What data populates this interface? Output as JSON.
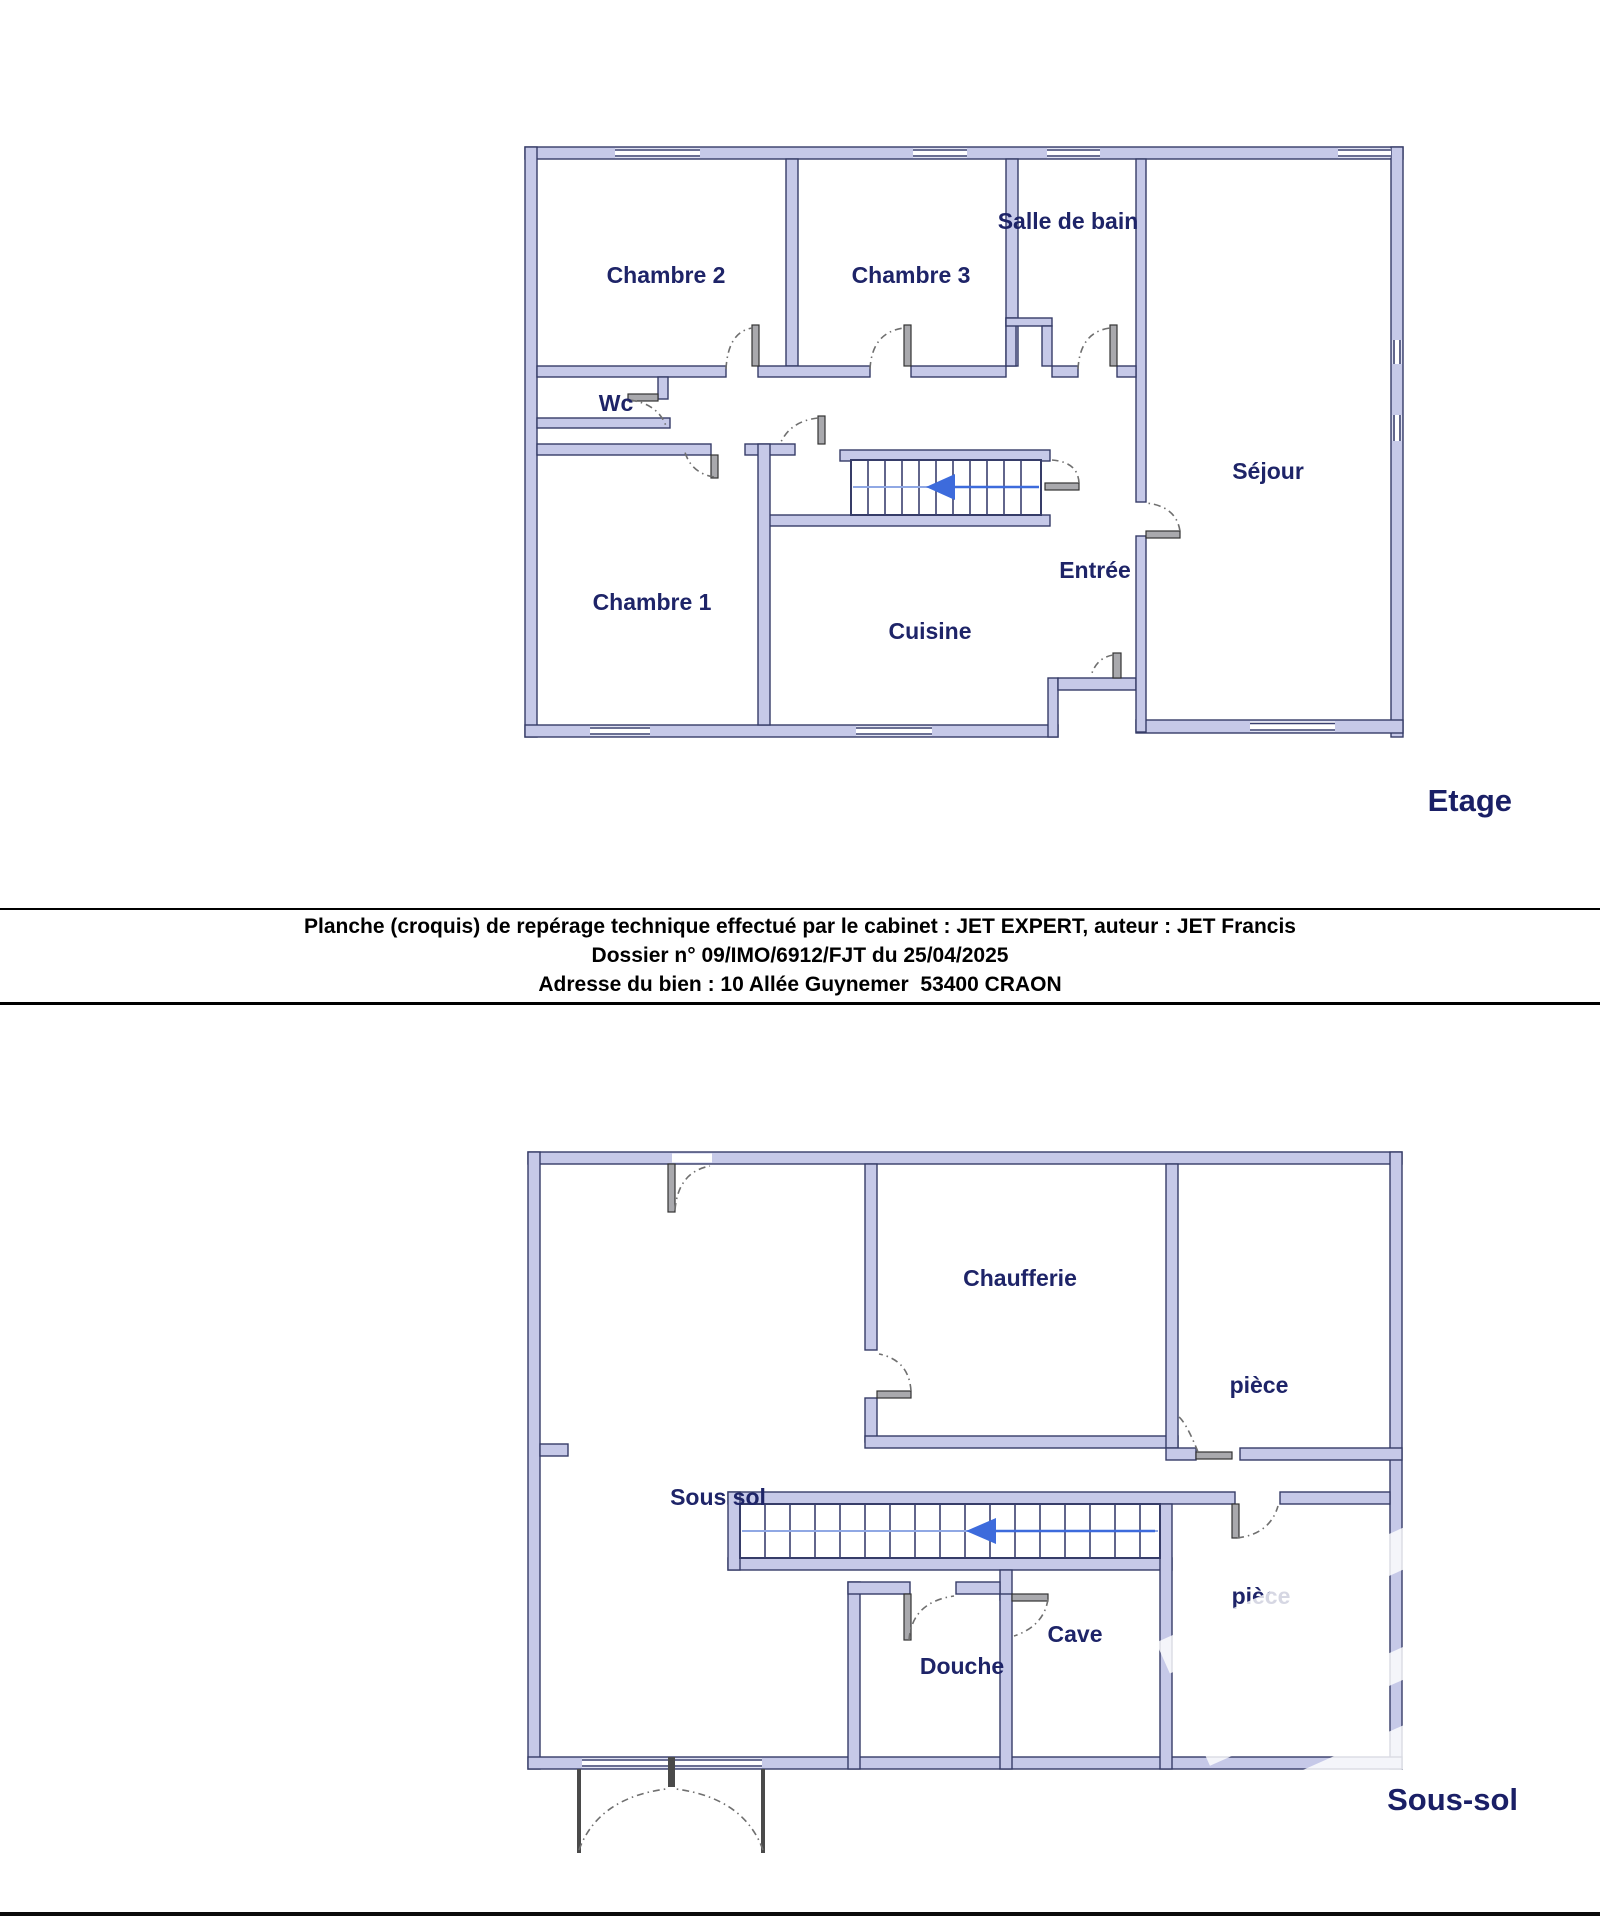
{
  "document": {
    "band": {
      "line1": "Planche (croquis) de repérage technique effectué par le cabinet : JET EXPERT, auteur : JET Francis",
      "line2": "Dossier n° 09/IMO/6912/FJT du 25/04/2025",
      "line3": "Adresse du bien : 10 Allée Guynemer  53400 CRAON"
    }
  },
  "floors": {
    "etage": {
      "title": "Etage",
      "rooms": {
        "chambre2": "Chambre 2",
        "chambre3": "Chambre 3",
        "salle_de_bain": "Salle de bain",
        "wc": "Wc",
        "chambre1": "Chambre 1",
        "cuisine": "Cuisine",
        "entree": "Entrée",
        "sejour": "Séjour"
      }
    },
    "sous_sol": {
      "title": "Sous-sol",
      "rooms": {
        "chaufferie": "Chaufferie",
        "piece_haut": "pièce",
        "sous_sol": "Sous sol",
        "piece_bas": "pièce",
        "cave": "Cave",
        "douche": "Douche"
      }
    }
  },
  "colors": {
    "wall_fill": "#c6c9e8",
    "wall_stroke": "#363c68",
    "room_label": "#1e2468",
    "stair_arrow": "#3d6bdc",
    "band_text": "#000000"
  }
}
